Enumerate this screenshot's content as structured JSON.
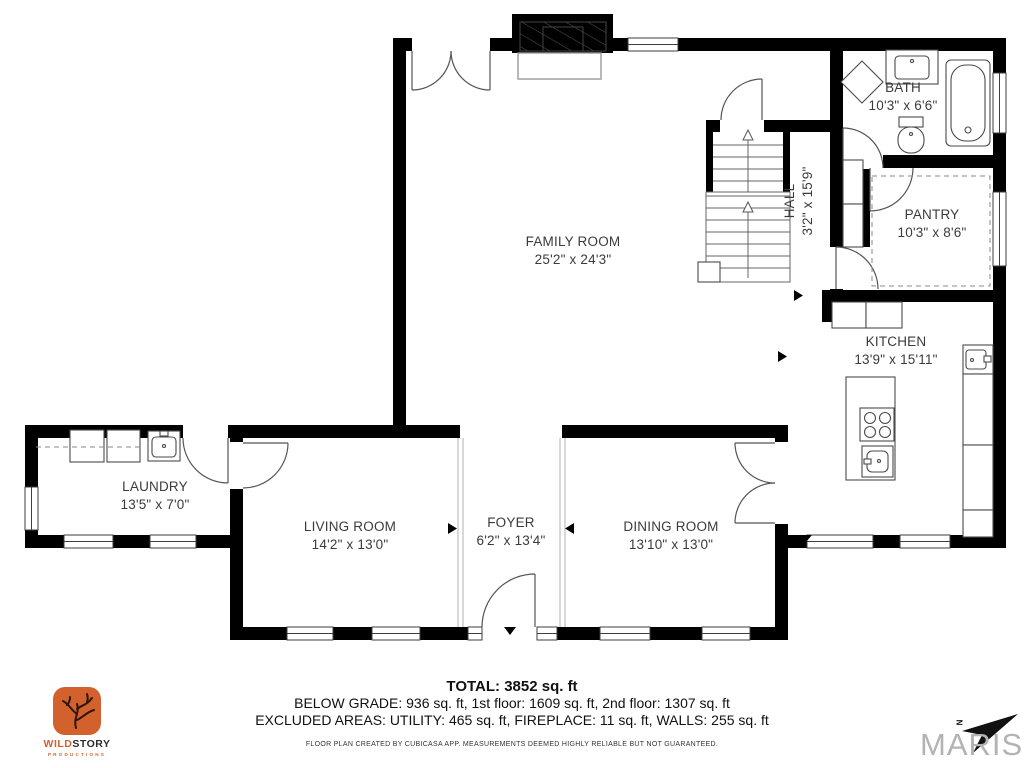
{
  "rooms": [
    {
      "id": "family-room",
      "name": "FAMILY ROOM",
      "dims": "25'2\" x 24'3\""
    },
    {
      "id": "bath",
      "name": "BATH",
      "dims": "10'3\" x 6'6\""
    },
    {
      "id": "hall",
      "name": "HALL",
      "dims": "3'2\" x 15'9\""
    },
    {
      "id": "pantry",
      "name": "PANTRY",
      "dims": "10'3\" x 8'6\""
    },
    {
      "id": "kitchen",
      "name": "KITCHEN",
      "dims": "13'9\" x 15'11\""
    },
    {
      "id": "laundry",
      "name": "LAUNDRY",
      "dims": "13'5\" x 7'0\""
    },
    {
      "id": "living-room",
      "name": "LIVING ROOM",
      "dims": "14'2\" x 13'0\""
    },
    {
      "id": "foyer",
      "name": "FOYER",
      "dims": "6'2\" x 13'4\""
    },
    {
      "id": "dining-room",
      "name": "DINING ROOM",
      "dims": "13'10\" x 13'0\""
    }
  ],
  "summary": {
    "total": "TOTAL: 3852 sq. ft",
    "floors": "BELOW GRADE: 936 sq. ft, 1st floor: 1609 sq. ft, 2nd floor: 1307 sq. ft",
    "excluded": "EXCLUDED AREAS: UTILITY: 465 sq. ft, FIREPLACE: 11 sq. ft, WALLS: 255 sq. ft",
    "disclaimer": "FLOOR PLAN CREATED BY CUBICASA APP. MEASUREMENTS DEEMED HIGHLY RELIABLE BUT NOT GUARANTEED."
  },
  "branding": {
    "wildstory": {
      "word1": "WILD",
      "word2": "STORY",
      "subtitle": "PRODUCTIONS"
    },
    "maris": {
      "label": "MARIS",
      "compass_letter": "N"
    }
  },
  "colors": {
    "wall": "#000000",
    "label_text": "#3b3b3b",
    "accent_orange": "#d2612e",
    "maris_gray": "#b3b3b3"
  }
}
